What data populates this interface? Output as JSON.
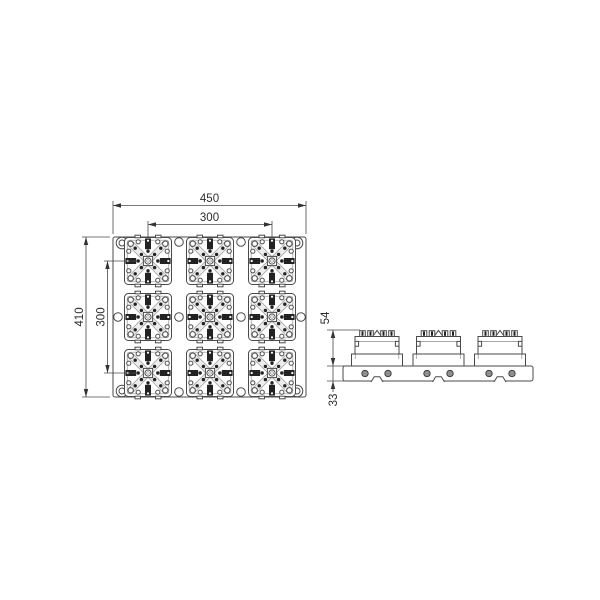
{
  "background": "#ffffff",
  "colors": {
    "line": "#4a4a4a",
    "dark_fill": "#222222",
    "band_fill": "#ececec",
    "hole_fill": "#8f8f8f",
    "dim_text": "#2e2e2e"
  },
  "top_view": {
    "grid_rows": 3,
    "grid_cols": 3,
    "module_count": 9,
    "dims": {
      "overall_width": "450",
      "module_pitch_x": "300",
      "overall_height": "410",
      "module_pitch_y": "300"
    }
  },
  "side_view": {
    "module_count": 3,
    "base_hole_count": 6,
    "dims": {
      "module_height": "54",
      "plate_thickness": "33"
    }
  }
}
